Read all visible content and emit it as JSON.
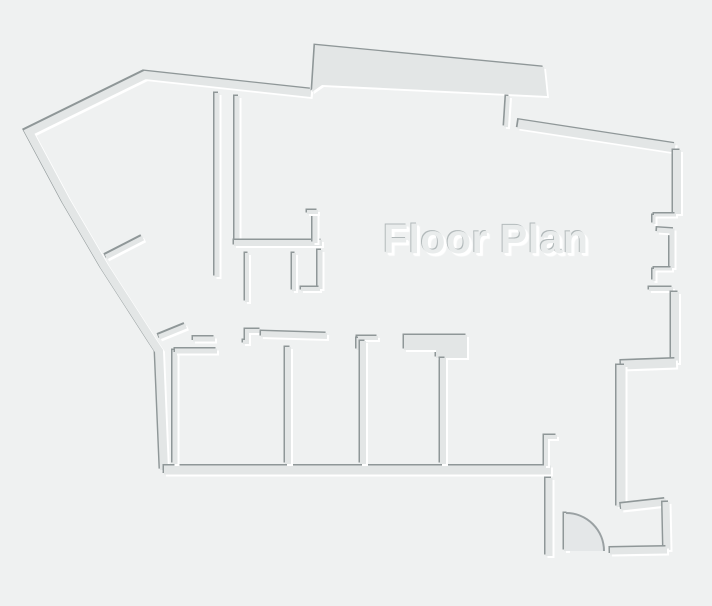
{
  "title": "Floor Plan",
  "canvas": {
    "width": 712,
    "height": 606
  },
  "floor_plan": {
    "colors": {
      "background": "#eff1f1",
      "wall": "#e3e6e6",
      "shadow": "#8f9798",
      "highlight": "#ffffff",
      "door_fan_fill": "#e4e7e8",
      "door_arc": "#9aa1a3"
    },
    "walls": [
      {
        "name": "outer-left-wall",
        "type": "line",
        "width": 8,
        "points": [
          [
            311,
            93
          ],
          [
            145,
            75
          ],
          [
            29,
            132
          ],
          [
            66,
            201
          ],
          [
            104,
            266
          ],
          [
            153,
            342
          ],
          [
            159,
            351
          ],
          [
            164,
            470
          ]
        ]
      },
      {
        "name": "top-bay-wall",
        "type": "polygon",
        "closed": true,
        "points": [
          [
            312,
            92
          ],
          [
            315,
            45
          ],
          [
            544,
            67
          ],
          [
            547,
            96
          ],
          [
            322,
            85
          ]
        ]
      },
      {
        "name": "bay-end-stub-wall",
        "type": "line",
        "width": 4,
        "points": [
          [
            508,
            96
          ],
          [
            506,
            127
          ]
        ]
      },
      {
        "name": "outer-top-right-wall",
        "type": "line",
        "width": 9,
        "points": [
          [
            518,
            124
          ],
          [
            675,
            148
          ]
        ]
      },
      {
        "name": "right-wall-upper",
        "type": "line",
        "width": 8,
        "points": [
          [
            677,
            150
          ],
          [
            677,
            214
          ]
        ]
      },
      {
        "name": "window-notch1-top",
        "type": "line",
        "width": 3,
        "points": [
          [
            654,
            215
          ],
          [
            676,
            215
          ]
        ]
      },
      {
        "name": "window-notch1-side",
        "type": "line",
        "width": 3,
        "points": [
          [
            654,
            215
          ],
          [
            654,
            224
          ]
        ]
      },
      {
        "name": "right-wall-middle",
        "type": "line",
        "width": 5,
        "points": [
          [
            657,
            230
          ],
          [
            672,
            231
          ],
          [
            672,
            268
          ]
        ]
      },
      {
        "name": "window-notch2-top",
        "type": "line",
        "width": 3,
        "points": [
          [
            654,
            269
          ],
          [
            672,
            269
          ]
        ]
      },
      {
        "name": "window-notch2-side",
        "type": "line",
        "width": 3,
        "points": [
          [
            654,
            269
          ],
          [
            654,
            281
          ]
        ]
      },
      {
        "name": "window-notch2-bottom",
        "type": "line",
        "width": 4,
        "points": [
          [
            649,
            289
          ],
          [
            673,
            289
          ]
        ]
      },
      {
        "name": "right-wall-lower",
        "type": "line",
        "width": 8,
        "points": [
          [
            675,
            292
          ],
          [
            675,
            363
          ]
        ]
      },
      {
        "name": "right-step-wall",
        "type": "line",
        "width": 9,
        "points": [
          [
            676,
            363
          ],
          [
            621,
            365
          ]
        ]
      },
      {
        "name": "right-wing-wall",
        "type": "line",
        "width": 9,
        "points": [
          [
            621,
            365
          ],
          [
            621,
            507
          ]
        ]
      },
      {
        "name": "entry-nook-top-wall",
        "type": "line",
        "width": 7,
        "points": [
          [
            621,
            507
          ],
          [
            666,
            502
          ]
        ]
      },
      {
        "name": "entry-nook-right-wall",
        "type": "line",
        "width": 7,
        "points": [
          [
            666,
            502
          ],
          [
            667,
            550
          ]
        ]
      },
      {
        "name": "entry-sill-wall",
        "type": "line",
        "width": 7,
        "points": [
          [
            667,
            550
          ],
          [
            610,
            551
          ]
        ]
      },
      {
        "name": "entry-door-leaf",
        "type": "line",
        "width": 4,
        "points": [
          [
            566,
            513
          ],
          [
            566,
            551
          ]
        ]
      },
      {
        "name": "entry-left-wall",
        "type": "line",
        "width": 7,
        "points": [
          [
            549,
            478
          ],
          [
            549,
            556
          ]
        ]
      },
      {
        "name": "bottom-wall",
        "type": "line",
        "width": 9,
        "points": [
          [
            164,
            470
          ],
          [
            551,
            470
          ]
        ]
      },
      {
        "name": "hall-stub-wall",
        "type": "line",
        "width": 4,
        "points": [
          [
            557,
            437
          ],
          [
            546,
            437
          ],
          [
            546,
            466
          ]
        ]
      },
      {
        "name": "room1-left-wall",
        "type": "line",
        "width": 5,
        "points": [
          [
            175,
            350
          ],
          [
            175,
            464
          ]
        ]
      },
      {
        "name": "room1-top-wall",
        "type": "line",
        "width": 5,
        "points": [
          [
            175,
            351
          ],
          [
            217,
            351
          ]
        ]
      },
      {
        "name": "hallway-dash-wall",
        "type": "line",
        "width": 5,
        "points": [
          [
            193,
            339
          ],
          [
            215,
            339
          ]
        ]
      },
      {
        "name": "hallway-step-wall",
        "type": "line",
        "width": 4,
        "points": [
          [
            243,
            342
          ],
          [
            247,
            342
          ],
          [
            247,
            331
          ],
          [
            261,
            331
          ]
        ]
      },
      {
        "name": "rooms-top-long-wall",
        "type": "line",
        "width": 6,
        "points": [
          [
            261,
            334
          ],
          [
            327,
            336
          ]
        ]
      },
      {
        "name": "room-divider1-wall",
        "type": "line",
        "width": 6,
        "points": [
          [
            288,
            347
          ],
          [
            288,
            464
          ]
        ]
      },
      {
        "name": "divider2-cap-wall",
        "type": "line",
        "width": 4,
        "points": [
          [
            357,
            338
          ],
          [
            378,
            338
          ]
        ]
      },
      {
        "name": "divider2-cap-leg",
        "type": "line",
        "width": 3,
        "points": [
          [
            358,
            338
          ],
          [
            358,
            350
          ]
        ]
      },
      {
        "name": "room-divider2-wall",
        "type": "line",
        "width": 6,
        "points": [
          [
            363,
            341
          ],
          [
            363,
            464
          ]
        ]
      },
      {
        "name": "rooms-top-thick-wall",
        "type": "polygon",
        "closed": true,
        "points": [
          [
            404,
            335
          ],
          [
            467,
            335
          ],
          [
            467,
            358
          ],
          [
            436,
            358
          ],
          [
            436,
            350
          ],
          [
            404,
            350
          ]
        ]
      },
      {
        "name": "room-divider3-wall",
        "type": "line",
        "width": 6,
        "points": [
          [
            443,
            358
          ],
          [
            443,
            464
          ]
        ]
      },
      {
        "name": "core-wall-a",
        "type": "line",
        "width": 5,
        "points": [
          [
            217,
            93
          ],
          [
            217,
            277
          ]
        ]
      },
      {
        "name": "core-wall-b",
        "type": "line",
        "width": 5,
        "points": [
          [
            237,
            96
          ],
          [
            237,
            241
          ]
        ]
      },
      {
        "name": "core-bottom-wall",
        "type": "line",
        "width": 6,
        "points": [
          [
            234,
            243
          ],
          [
            322,
            243
          ]
        ]
      },
      {
        "name": "core-riser-wall",
        "type": "line",
        "width": 5,
        "points": [
          [
            315,
            243
          ],
          [
            315,
            212
          ]
        ]
      },
      {
        "name": "core-riser-hook",
        "type": "line",
        "width": 4,
        "points": [
          [
            307,
            212
          ],
          [
            318,
            212
          ]
        ]
      },
      {
        "name": "core-stub-a",
        "type": "line",
        "width": 4,
        "points": [
          [
            247,
            253
          ],
          [
            247,
            302
          ]
        ]
      },
      {
        "name": "core-stub-b",
        "type": "line",
        "width": 4,
        "points": [
          [
            294,
            253
          ],
          [
            294,
            291
          ]
        ]
      },
      {
        "name": "core-wall-c",
        "type": "line",
        "width": 5,
        "points": [
          [
            320,
            250
          ],
          [
            320,
            289
          ]
        ]
      },
      {
        "name": "core-wall-c-foot",
        "type": "line",
        "width": 4,
        "points": [
          [
            301,
            289
          ],
          [
            320,
            289
          ]
        ]
      },
      {
        "name": "diagonal-stub1-wall",
        "type": "line",
        "width": 5,
        "points": [
          [
            106,
            257
          ],
          [
            143,
            238
          ]
        ]
      },
      {
        "name": "diagonal-stub2-wall",
        "type": "line",
        "width": 5,
        "points": [
          [
            159,
            337
          ],
          [
            186,
            326
          ]
        ]
      }
    ],
    "door": {
      "name": "entry-door-swing",
      "start": [
        566,
        513
      ],
      "end": [
        604,
        551
      ],
      "hinge": [
        566,
        551
      ],
      "radius": 38
    },
    "emboss": {
      "shadow_offset": [
        -1.5,
        -1.5
      ],
      "highlight_offset": [
        2,
        2
      ]
    }
  }
}
